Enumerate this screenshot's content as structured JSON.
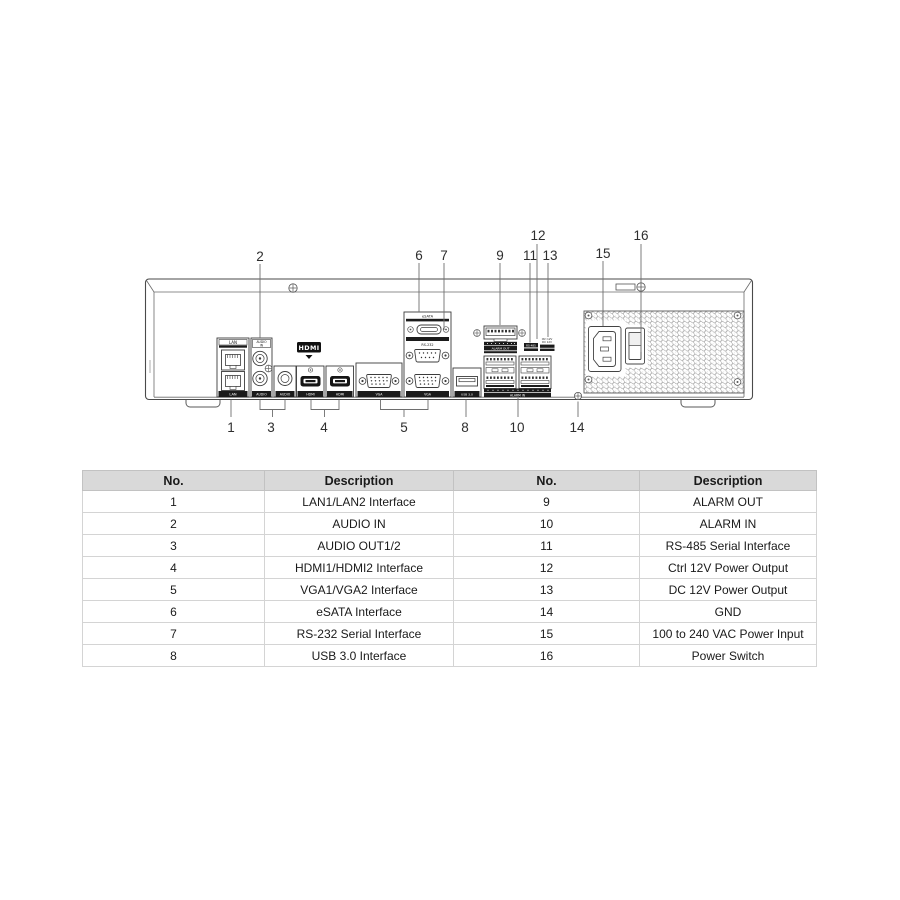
{
  "diagram": {
    "callouts": {
      "c1": "1",
      "c2": "2",
      "c3": "3",
      "c4": "4",
      "c5": "5",
      "c6": "6",
      "c7": "7",
      "c8": "8",
      "c9": "9",
      "c10": "10",
      "c11": "11",
      "c12": "12",
      "c13": "13",
      "c14": "14",
      "c15": "15",
      "c16": "16"
    },
    "labels": {
      "lan": "LAN",
      "audio": "AUDIO",
      "audio_in_line1": "AUDIO",
      "audio_in_line2": "IN",
      "hdmi_logo": "HDMI",
      "hdmi": "HDMI",
      "vga": "VGA",
      "esata": "eSATA",
      "rs232": "RS-232",
      "usb": "USB 3.0",
      "alarm_out": "ALARM OUT",
      "alarm_in": "ALARM IN",
      "rs485": "RS-485",
      "ctrl12v": "Ctrl 12V",
      "dc12v": "DC 12V"
    }
  },
  "table": {
    "headers": [
      "No.",
      "Description",
      "No.",
      "Description"
    ],
    "rows": [
      [
        "1",
        "LAN1/LAN2 Interface",
        "9",
        "ALARM OUT"
      ],
      [
        "2",
        "AUDIO IN",
        "10",
        "ALARM IN"
      ],
      [
        "3",
        "AUDIO OUT1/2",
        "11",
        "RS-485 Serial Interface"
      ],
      [
        "4",
        "HDMI1/HDMI2 Interface",
        "12",
        "Ctrl 12V Power Output"
      ],
      [
        "5",
        "VGA1/VGA2 Interface",
        "13",
        "DC 12V Power Output"
      ],
      [
        "6",
        "eSATA Interface",
        "14",
        "GND"
      ],
      [
        "7",
        "RS-232 Serial Interface",
        "15",
        "100 to 240 VAC Power Input"
      ],
      [
        "8",
        "USB 3.0 Interface",
        "16",
        "Power Switch"
      ]
    ]
  },
  "colors": {
    "table_header_bg": "#d9d9d9",
    "table_border": "#c9c9c9",
    "strip_black": "#1b1b1b",
    "line_gray": "#666666"
  }
}
